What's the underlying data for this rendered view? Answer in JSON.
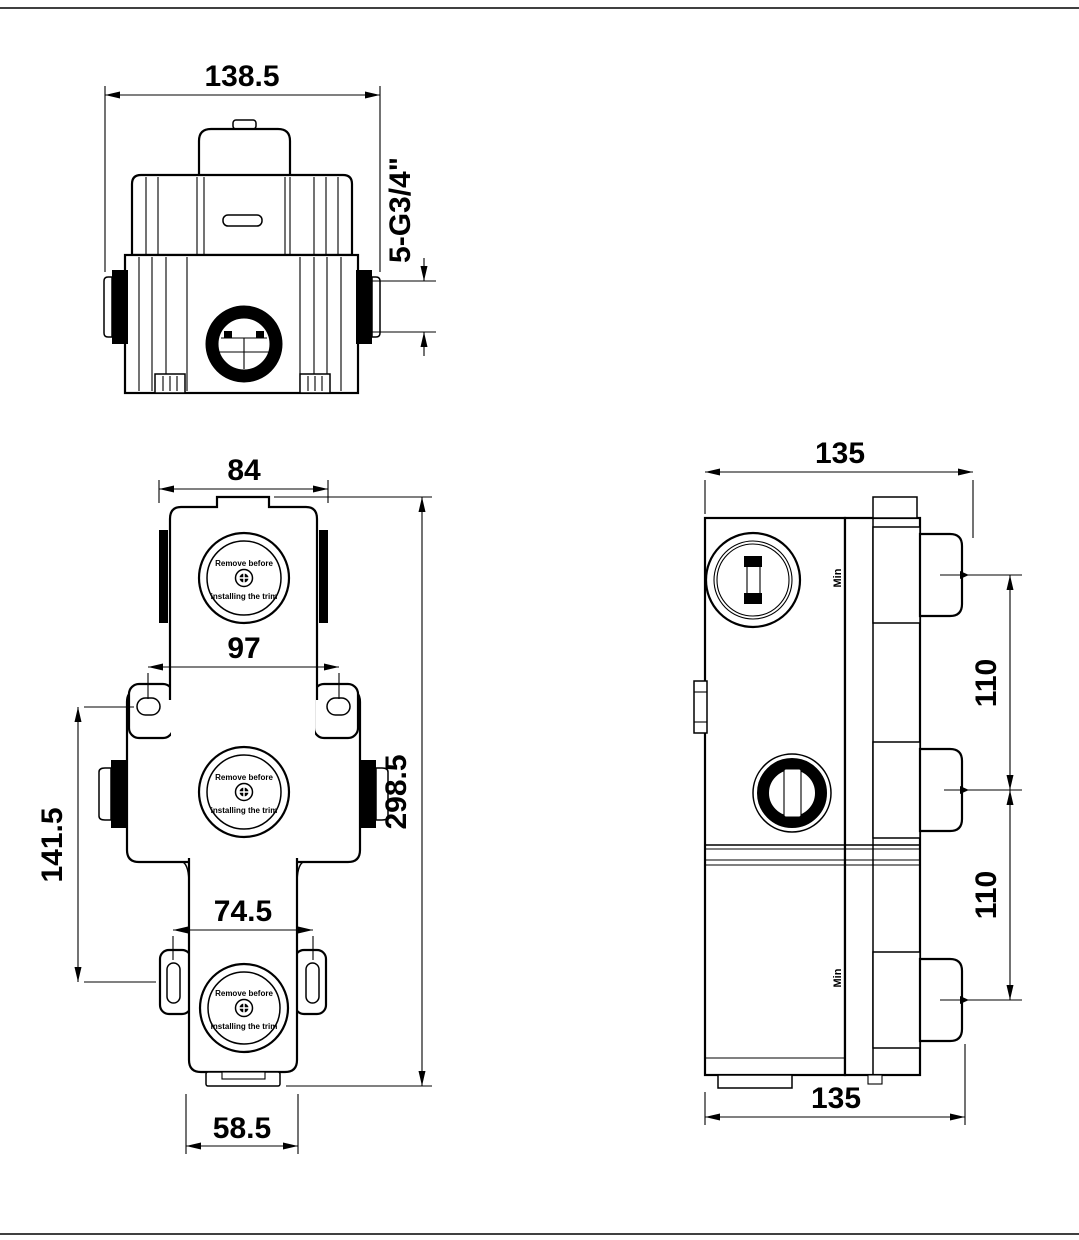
{
  "colors": {
    "line": "#000000",
    "background": "#ffffff"
  },
  "top_view": {
    "dim_width": "138.5",
    "dim_ports": "5-G3/4\""
  },
  "front_view": {
    "dim_top_width": "84",
    "dim_ear_spacing": "97",
    "dim_lower_ear_spacing": "74.5",
    "dim_bottom_width": "58.5",
    "dim_ear_vertical": "141.5",
    "dim_height": "298.5",
    "cap_line1": "Remove before",
    "cap_line2": "installing the trim"
  },
  "side_view": {
    "dim_top_width": "135",
    "dim_bottom_width": "135",
    "dim_port_spacing_upper": "110",
    "dim_port_spacing_lower": "110",
    "min_label": "Min"
  }
}
